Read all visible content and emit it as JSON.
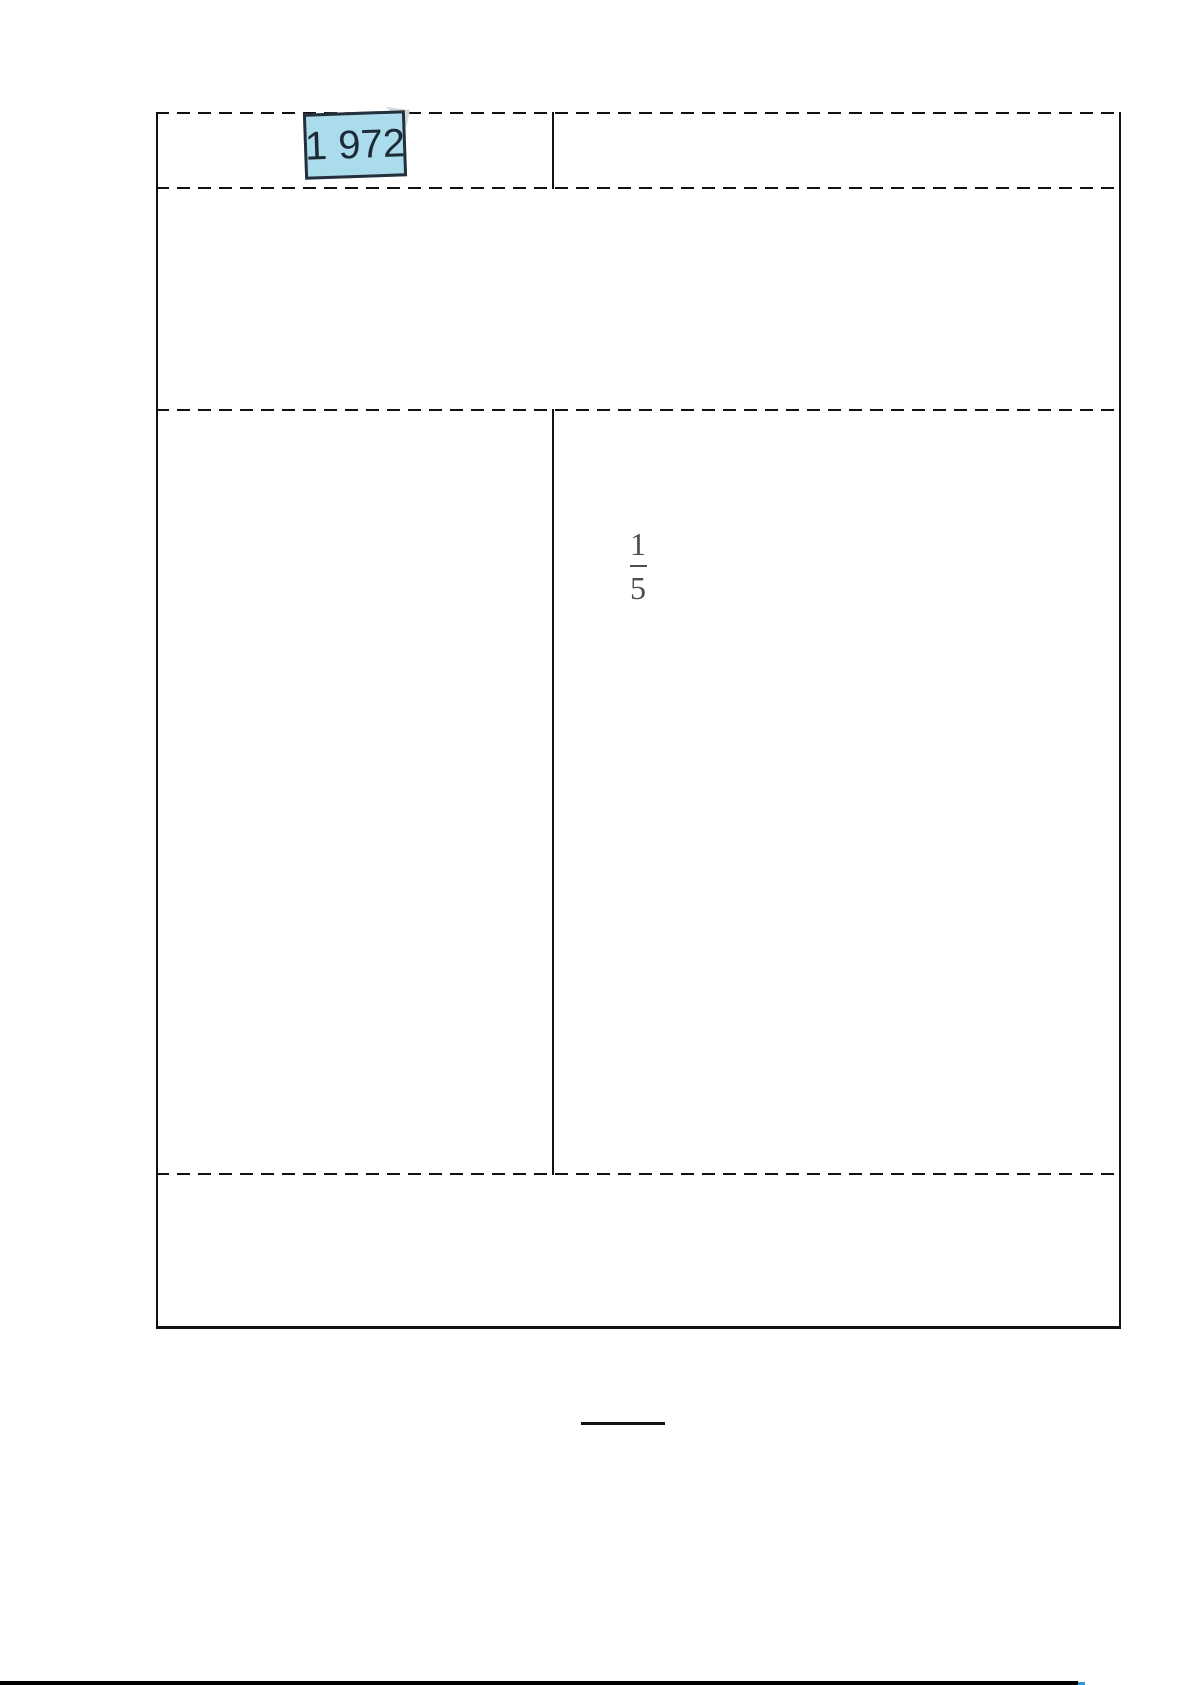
{
  "header": {
    "year_label": "1 972"
  },
  "problem": {
    "fraction": {
      "numerator": "1",
      "denominator": "5"
    }
  },
  "table": {
    "rows": 4,
    "row_1": {
      "left_cell": "year-label-box",
      "right_cell": ""
    },
    "row_2": {
      "merged_cell": ""
    },
    "row_3": {
      "left_cell": "",
      "right_cell": "fraction 1/5"
    },
    "row_4": {
      "merged_cell": ""
    },
    "border_style": "dashed horizontal dividers, solid vertical borders, solid bottom"
  },
  "colors": {
    "label_box_fill": "#aadcec",
    "label_box_border": "#24313d",
    "label_text": "#1d2b36",
    "fraction_text": "#4d4d4d",
    "table_line": "#111111",
    "page_bottom_edge": "#000000",
    "page_bottom_edge_accent": "#2e9bd6"
  }
}
